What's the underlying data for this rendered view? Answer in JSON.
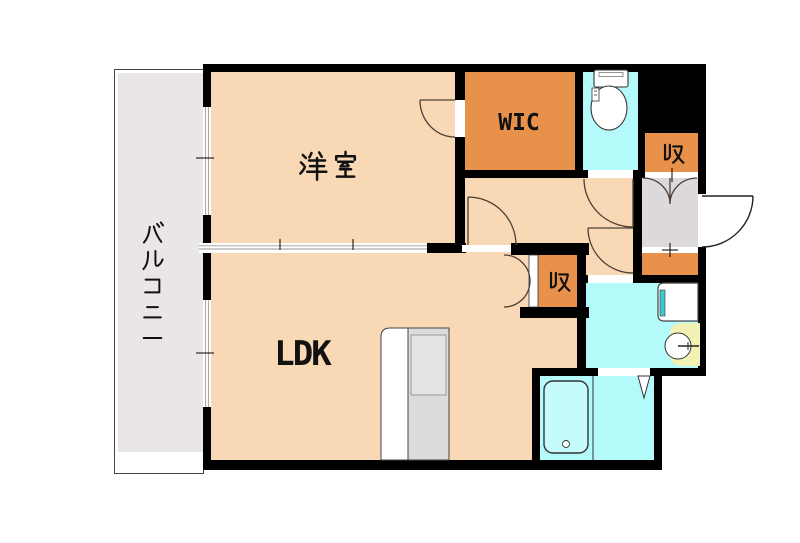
{
  "meta": {
    "kind": "real-estate-floor-plan",
    "units_shown": "none"
  },
  "labels": {
    "balcony": "バルコニー",
    "bedroom": "洋室",
    "wic": "WIC",
    "ldk": "LDK",
    "storage_upper": "収",
    "storage_lower": "収"
  },
  "rooms": [
    {
      "id": "balcony",
      "label": "バルコニー",
      "color": "#E9E5E8"
    },
    {
      "id": "bedroom",
      "label": "洋室",
      "color": "#F8D8B5"
    },
    {
      "id": "wic",
      "label": "WIC",
      "color": "#E8914B"
    },
    {
      "id": "ldk",
      "label": "LDK",
      "color": "#F8D8B5"
    },
    {
      "id": "storage-upper",
      "label": "収",
      "color": "#E8914B"
    },
    {
      "id": "storage-lower",
      "label": "収",
      "color": "#E8914B"
    },
    {
      "id": "hallway",
      "label": "",
      "color": "#F8D8B5"
    },
    {
      "id": "toilet-room",
      "label": "",
      "color": "#B5FAFA"
    },
    {
      "id": "washroom",
      "label": "",
      "color": "#B5FAFA"
    },
    {
      "id": "bathroom",
      "label": "",
      "color": "#B5FAFA"
    },
    {
      "id": "entry",
      "label": "",
      "color": "#DCD8DB"
    },
    {
      "id": "shoe-cabinet",
      "label": "",
      "color": "#E8914B"
    }
  ],
  "fixtures": [
    "toilet",
    "washing-machine-pan",
    "wash-basin",
    "bathtub",
    "kitchen-counter",
    "entry-door",
    "sliding-windows",
    "sliding-partition",
    "folding-bath-door"
  ],
  "colors": {
    "wall": "#000000",
    "room_peach": "#F8D8B5",
    "closet_orange": "#E8914B",
    "water_cyan": "#B5FAFA",
    "tub_cyan": "#C6FBFB",
    "balcony_gray": "#E9E5E8",
    "entry_gray": "#DCD8DB",
    "sink_yellow": "#F2F2B4",
    "kitchen_gray": "#DCDCDC",
    "washer_teal": "#3EC9CD",
    "door_arc": "#4d4035"
  }
}
